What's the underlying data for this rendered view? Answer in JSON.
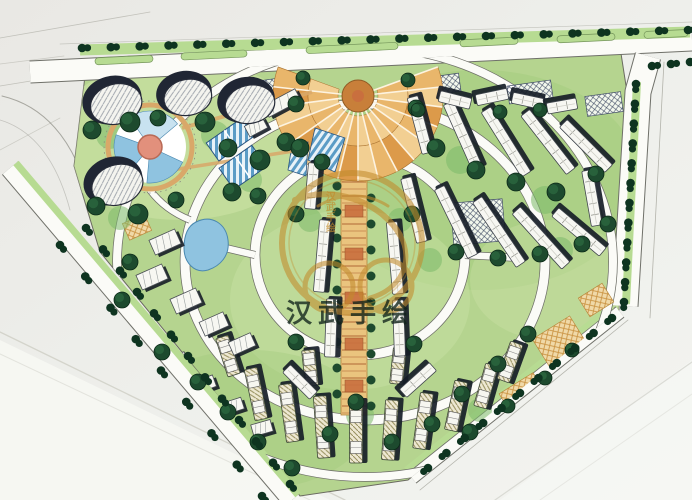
{
  "meta": {
    "drawing_type": "hand-drawn residential community master plan (marker rendering)",
    "visible_text_note": "only watermark text is legible on the drawing"
  },
  "watermark": {
    "brand_text": "汉武手绘",
    "vertical_text": [
      "汉",
      "武",
      "手",
      "绘"
    ],
    "gold": "#c28b2c",
    "text_color": "rgba(16,34,26,0.78)"
  },
  "palette": {
    "paper": "#edeeea",
    "paperLight": "#f6f7f3",
    "paperShade": "#e7e6e2",
    "lawn": "#b5d48f",
    "lawnLight": "#cde3a8",
    "lawnDark": "#9cc876",
    "treeDark": "#1d4a2e",
    "treeDarker": "#0e3420",
    "treeHi": "#2e6b42",
    "shrub": "#7cb96a",
    "road": "#fbfbf7",
    "roadEdge": "#6f7069",
    "pencil": "#9a9a90",
    "verge": "#b7db92",
    "vergeEdge": "#74955a",
    "towerDark": "#202634",
    "white": "#f7f7f2",
    "shadow": "#161d27",
    "orange": "#e9b66b",
    "orangeLight": "#f2cf92",
    "orangeMid": "#dc9a4a",
    "orangeDeep": "#c87f3a",
    "rust": "#c96f3e",
    "axis": "#eac47e",
    "axisRung": "#aa5f2e",
    "tan": "#d9a869",
    "water": "#8fc3e0",
    "waterDeep": "#5b9cc6",
    "waterLight": "#c8e2f0",
    "salmon": "#e2907c",
    "gold": "#c28b2c",
    "blockTick": "#8f9089"
  },
  "plan": {
    "site_polygon": "85,76 620,47 627,92 619,310 408,480 300,496 100,252 74,166",
    "towers": [
      [
        112,
        100,
        30,
        24,
        -15
      ],
      [
        184,
        93,
        28,
        22,
        -10
      ],
      [
        246,
        100,
        29,
        23,
        -12
      ],
      [
        113,
        181,
        30,
        24,
        -18
      ]
    ],
    "capsules": [
      [
        124,
        60,
        58
      ],
      [
        214,
        55,
        66
      ],
      [
        352,
        48,
        92
      ],
      [
        489,
        42,
        58
      ],
      [
        586,
        38,
        58
      ],
      [
        666,
        34,
        44
      ]
    ],
    "street_tree_rows": [
      [
        82,
        48,
        688,
        30,
        22
      ],
      [
        636,
        84,
        624,
        302,
        12
      ],
      [
        612,
        318,
        428,
        468,
        11
      ],
      [
        86,
        228,
        290,
        484,
        13
      ],
      [
        60,
        245,
        262,
        496,
        9
      ],
      [
        652,
        66,
        690,
        62,
        3
      ]
    ],
    "rows_white": [
      [
        420,
        125,
        58,
        75
      ],
      [
        463,
        136,
        72,
        66
      ],
      [
        506,
        142,
        76,
        58
      ],
      [
        548,
        142,
        74,
        52
      ],
      [
        586,
        146,
        64,
        45
      ],
      [
        592,
        198,
        56,
        80
      ],
      [
        414,
        210,
        66,
        76
      ],
      [
        456,
        222,
        76,
        64
      ],
      [
        499,
        232,
        78,
        56
      ],
      [
        541,
        238,
        74,
        48
      ],
      [
        579,
        232,
        62,
        40
      ],
      [
        322,
        256,
        72,
        95
      ],
      [
        331,
        328,
        58,
        92
      ],
      [
        395,
        258,
        72,
        85
      ],
      [
        399,
        328,
        56,
        88
      ],
      [
        312,
        186,
        46,
        95
      ],
      [
        455,
        100,
        32,
        14
      ],
      [
        492,
        97,
        32,
        -12
      ],
      [
        528,
        101,
        32,
        12
      ],
      [
        562,
        106,
        30,
        -10
      ],
      [
        300,
        382,
        38,
        45
      ],
      [
        418,
        380,
        40,
        -42
      ]
    ],
    "rows_hatch": [
      [
        256,
        394,
        52,
        78
      ],
      [
        289,
        413,
        58,
        82
      ],
      [
        322,
        427,
        62,
        86
      ],
      [
        356,
        432,
        62,
        90
      ],
      [
        390,
        430,
        60,
        94
      ],
      [
        423,
        421,
        56,
        98
      ],
      [
        456,
        406,
        50,
        102
      ],
      [
        486,
        386,
        44,
        106
      ],
      [
        310,
        368,
        36,
        84
      ],
      [
        398,
        366,
        36,
        96
      ],
      [
        228,
        356,
        40,
        72
      ],
      [
        510,
        362,
        40,
        110
      ]
    ],
    "blocks": [
      [
        165,
        242,
        28,
        16,
        -24
      ],
      [
        152,
        277,
        28,
        16,
        -24
      ],
      [
        186,
        301,
        28,
        16,
        -24
      ],
      [
        214,
        324,
        26,
        15,
        -24
      ],
      [
        242,
        344,
        24,
        14,
        -24
      ],
      [
        282,
        103,
        36,
        13,
        -28
      ],
      [
        256,
        127,
        20,
        12,
        -28
      ],
      [
        150,
        336,
        20,
        12,
        -24
      ],
      [
        177,
        361,
        20,
        12,
        -22
      ],
      [
        205,
        384,
        20,
        12,
        -20
      ],
      [
        233,
        406,
        20,
        12,
        -18
      ],
      [
        262,
        428,
        20,
        12,
        -16
      ]
    ],
    "patches": [
      [
        266,
        88,
        44,
        16,
        -8,
        "c"
      ],
      [
        432,
        86,
        56,
        18,
        -8,
        "c"
      ],
      [
        530,
        92,
        44,
        18,
        -8,
        "c"
      ],
      [
        604,
        104,
        36,
        20,
        -8,
        "c"
      ],
      [
        478,
        222,
        52,
        42,
        -5,
        "c"
      ],
      [
        560,
        342,
        44,
        34,
        -32,
        "t"
      ],
      [
        524,
        396,
        40,
        30,
        -32,
        "t"
      ],
      [
        596,
        300,
        28,
        22,
        -32,
        "t"
      ],
      [
        137,
        227,
        24,
        18,
        -24,
        "t"
      ]
    ],
    "trees": [
      [
        92,
        130,
        9
      ],
      [
        130,
        122,
        10
      ],
      [
        158,
        118,
        8
      ],
      [
        205,
        122,
        10
      ],
      [
        228,
        148,
        9
      ],
      [
        260,
        160,
        10
      ],
      [
        286,
        142,
        9
      ],
      [
        96,
        206,
        9
      ],
      [
        138,
        214,
        10
      ],
      [
        176,
        200,
        8
      ],
      [
        232,
        192,
        9
      ],
      [
        258,
        196,
        8
      ],
      [
        303,
        78,
        7
      ],
      [
        408,
        80,
        7
      ],
      [
        296,
        104,
        8
      ],
      [
        416,
        108,
        8
      ],
      [
        300,
        148,
        9
      ],
      [
        322,
        162,
        8
      ],
      [
        436,
        148,
        9
      ],
      [
        476,
        170,
        9
      ],
      [
        516,
        182,
        9
      ],
      [
        556,
        192,
        9
      ],
      [
        596,
        174,
        8
      ],
      [
        608,
        224,
        8
      ],
      [
        582,
        244,
        8
      ],
      [
        540,
        254,
        8
      ],
      [
        498,
        258,
        8
      ],
      [
        456,
        252,
        8
      ],
      [
        418,
        110,
        7
      ],
      [
        500,
        112,
        7
      ],
      [
        540,
        110,
        7
      ],
      [
        296,
        214,
        8
      ],
      [
        412,
        214,
        8
      ],
      [
        296,
        342,
        8
      ],
      [
        414,
        344,
        8
      ],
      [
        356,
        402,
        8
      ],
      [
        330,
        434,
        8
      ],
      [
        392,
        442,
        8
      ],
      [
        432,
        424,
        8
      ],
      [
        462,
        394,
        8
      ],
      [
        498,
        364,
        8
      ],
      [
        528,
        334,
        8
      ],
      [
        130,
        262,
        8
      ],
      [
        122,
        300,
        8
      ],
      [
        162,
        352,
        8
      ],
      [
        198,
        382,
        8
      ],
      [
        228,
        412,
        8
      ],
      [
        258,
        442,
        8
      ],
      [
        292,
        468,
        8
      ],
      [
        470,
        432,
        8
      ],
      [
        508,
        406,
        7
      ],
      [
        545,
        378,
        7
      ],
      [
        572,
        350,
        7
      ]
    ],
    "shrubs": [
      [
        110,
        135,
        14
      ],
      [
        215,
        135,
        14
      ],
      [
        250,
        180,
        12
      ],
      [
        120,
        218,
        12
      ],
      [
        310,
        150,
        12
      ],
      [
        460,
        160,
        14
      ],
      [
        545,
        200,
        14
      ],
      [
        310,
        220,
        12
      ],
      [
        400,
        220,
        12
      ],
      [
        360,
        415,
        14
      ],
      [
        200,
        390,
        12
      ],
      [
        480,
        410,
        12
      ],
      [
        560,
        250,
        13
      ],
      [
        430,
        260,
        12
      ]
    ],
    "axis": {
      "cx": 354,
      "top": 150,
      "bottom": 415,
      "half_w": 13
    },
    "plaza": {
      "cx": 358,
      "cy": 96,
      "r_outer": 85,
      "r_mid": 50,
      "r_hub": 16,
      "a1": -20,
      "a2": 200,
      "slots": 16
    },
    "pool": {
      "cx": 150,
      "cy": 147,
      "r": 36
    }
  }
}
